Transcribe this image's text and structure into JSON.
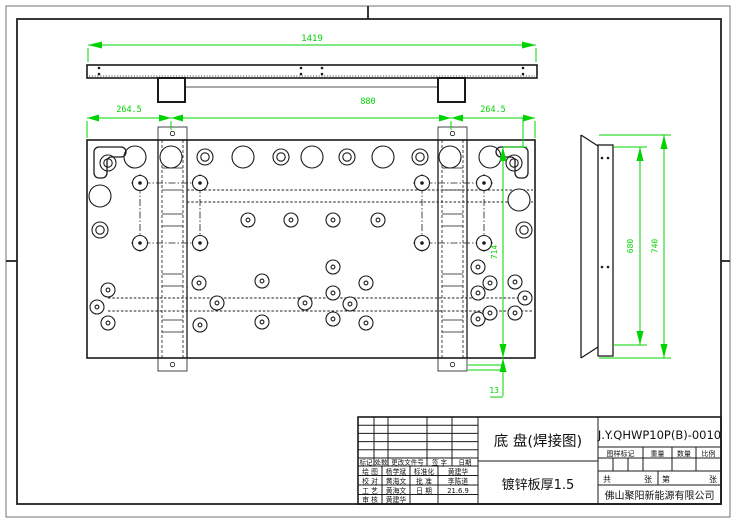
{
  "colors": {
    "dimension_green": "#00d400",
    "line_black": "#1a1a1a",
    "paper": "#ffffff"
  },
  "views": {
    "top_view": {
      "dim_total": "1419"
    },
    "front_view": {
      "dim_left": "264.5",
      "dim_mid": "880",
      "dim_right": "264.5",
      "dim_height": "714",
      "dim_offset": "13"
    },
    "side_view": {
      "dim_inner": "680",
      "dim_outer": "740"
    }
  },
  "title_block": {
    "part_name": "底 盘(焊接图)",
    "material_note": "镀锌板厚1.5",
    "drawing_number": "J.Y.QHWP10P(B)-0010",
    "stamp_headers": [
      "图样标记",
      "重量",
      "数量",
      "比例"
    ],
    "sheet_row": {
      "total_label": "共",
      "total_unit": "张",
      "no_label": "第",
      "no_unit": "张"
    },
    "company": "佛山聚阳新能源有限公司",
    "revision_headers": [
      "标记",
      "处数",
      "更改文件号",
      "签 字",
      "日期"
    ],
    "approval_rows": [
      {
        "role": "绘 图",
        "name": "杨学斌",
        "role2": "标准化",
        "name2": "黄建华"
      },
      {
        "role": "校 对",
        "name": "黄海文",
        "role2": "批 准",
        "name2": "李陈道"
      },
      {
        "role": "工 艺",
        "name": "黄海文",
        "role2": "日 期",
        "name2": "21.6.9"
      },
      {
        "role": "审 核",
        "name": "黄建华",
        "role2": "",
        "name2": ""
      }
    ]
  },
  "drawing_geometry": {
    "front": {
      "plate": [
        87,
        140,
        448,
        218
      ],
      "large": [
        [
          135,
          157
        ],
        [
          171,
          157
        ],
        [
          243,
          157
        ],
        [
          312,
          157
        ],
        [
          383,
          157
        ],
        [
          450,
          157
        ],
        [
          490,
          157
        ],
        [
          100,
          196
        ],
        [
          519,
          200
        ]
      ],
      "rings": [
        [
          205,
          157
        ],
        [
          281,
          157
        ],
        [
          347,
          157
        ],
        [
          420,
          157
        ],
        [
          108,
          163
        ],
        [
          514,
          163
        ],
        [
          100,
          230
        ],
        [
          524,
          230
        ]
      ],
      "small": [
        [
          248,
          220
        ],
        [
          291,
          220
        ],
        [
          333,
          220
        ],
        [
          378,
          220
        ],
        [
          199,
          283
        ],
        [
          262,
          281
        ],
        [
          366,
          283
        ],
        [
          217,
          303
        ],
        [
          305,
          303
        ],
        [
          350,
          304
        ],
        [
          200,
          325
        ],
        [
          262,
          322
        ],
        [
          366,
          323
        ],
        [
          333,
          267
        ],
        [
          333,
          293
        ],
        [
          333,
          319
        ],
        [
          478,
          267
        ],
        [
          478,
          293
        ],
        [
          478,
          319
        ],
        [
          108,
          290
        ],
        [
          97,
          307
        ],
        [
          108,
          323
        ],
        [
          490,
          283
        ],
        [
          515,
          282
        ],
        [
          490,
          313
        ],
        [
          515,
          313
        ],
        [
          525,
          298
        ]
      ],
      "bolt_groups": [
        [
          140,
          183,
          200,
          243
        ],
        [
          422,
          183,
          484,
          243
        ]
      ],
      "stiffeners": [
        158,
        438
      ],
      "stiffener_w": 29,
      "rungs": [
        168,
        190,
        214,
        226,
        274,
        286,
        320,
        332
      ],
      "bands": [
        [
          187,
          190,
          533
        ],
        [
          187,
          202,
          533
        ],
        [
          108,
          298,
          533
        ],
        [
          108,
          311,
          533
        ]
      ]
    },
    "top": {
      "bar": [
        87,
        65,
        450,
        13
      ],
      "feet": [
        [
          158,
          78,
          27,
          24
        ],
        [
          438,
          78,
          27,
          24
        ]
      ],
      "dots": [
        [
          99,
          68
        ],
        [
          99,
          74
        ],
        [
          301,
          68
        ],
        [
          301,
          74
        ],
        [
          322,
          68
        ],
        [
          322,
          74
        ],
        [
          523,
          68
        ],
        [
          523,
          74
        ]
      ]
    },
    "side": {
      "dots": [
        [
          602,
          158
        ],
        [
          608,
          158
        ],
        [
          602,
          267
        ],
        [
          608,
          267
        ]
      ]
    }
  }
}
